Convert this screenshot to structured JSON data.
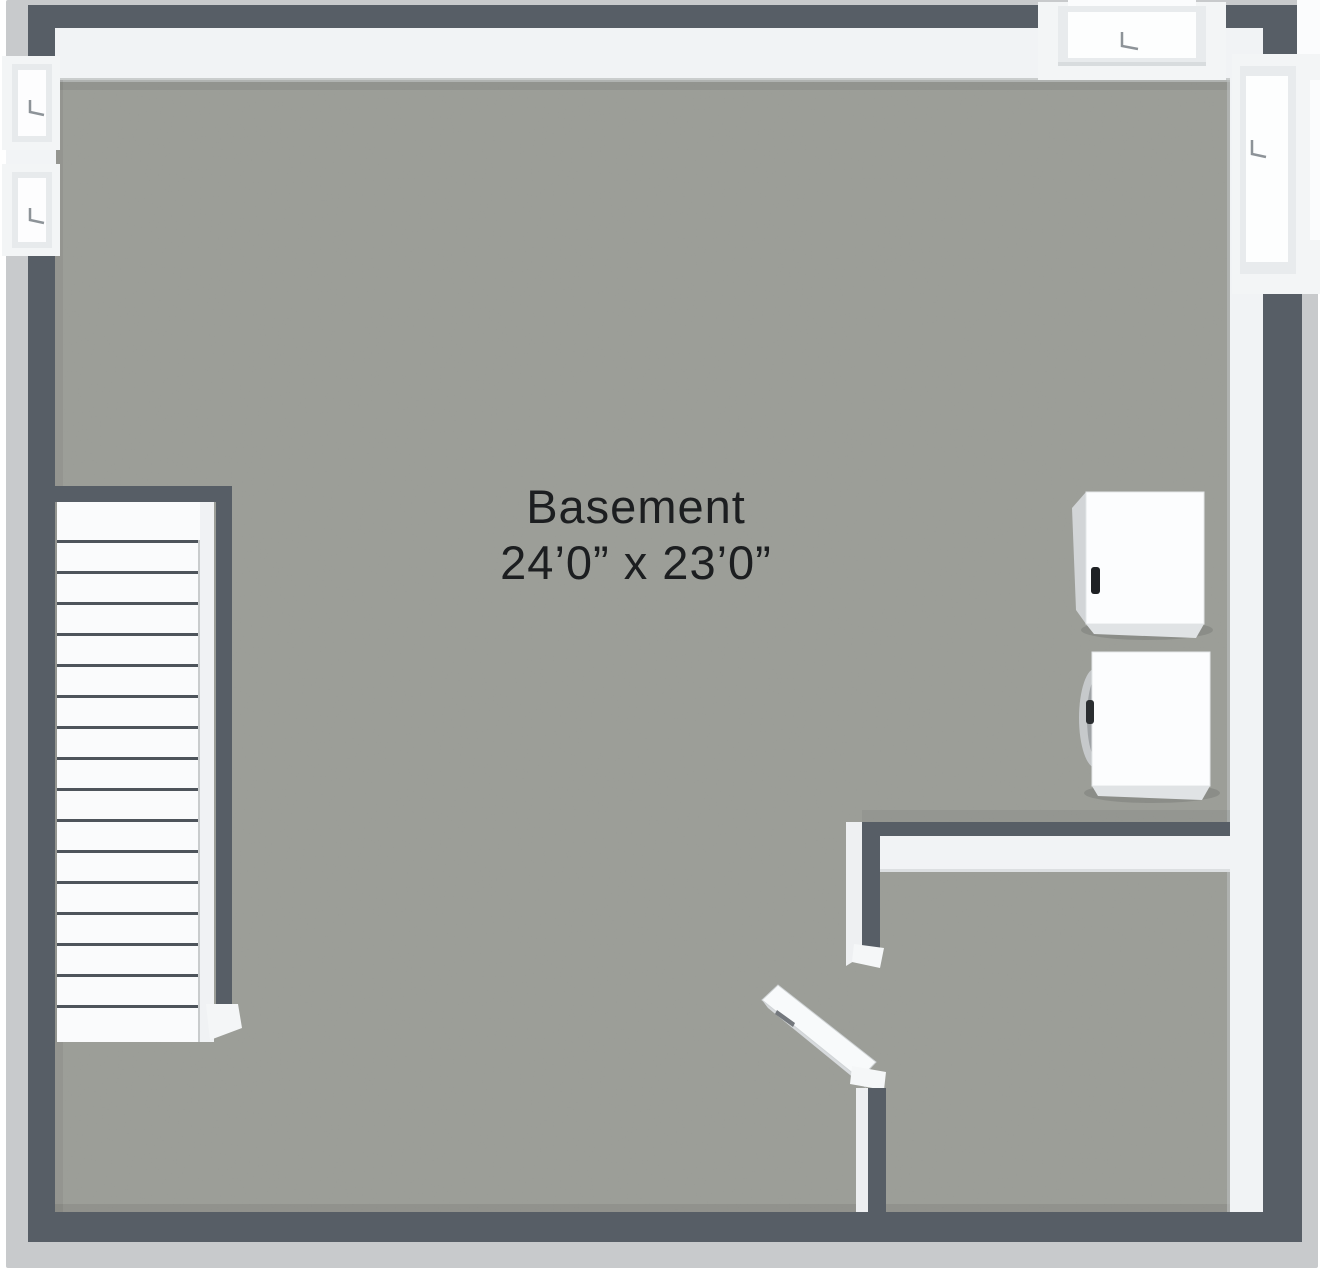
{
  "floorplan": {
    "view": "3d-top-down-floor-plan",
    "room_label": "Basement",
    "room_dimensions": "24’0” x 23’0”",
    "colors": {
      "wall_dark": "#575e66",
      "wall_outer": "#c8cacc",
      "wall_inner_face": "#f1f3f5",
      "floor": "#9b9d97",
      "stairs_white": "#fafbfc",
      "label_text": "#1c1e20"
    }
  }
}
